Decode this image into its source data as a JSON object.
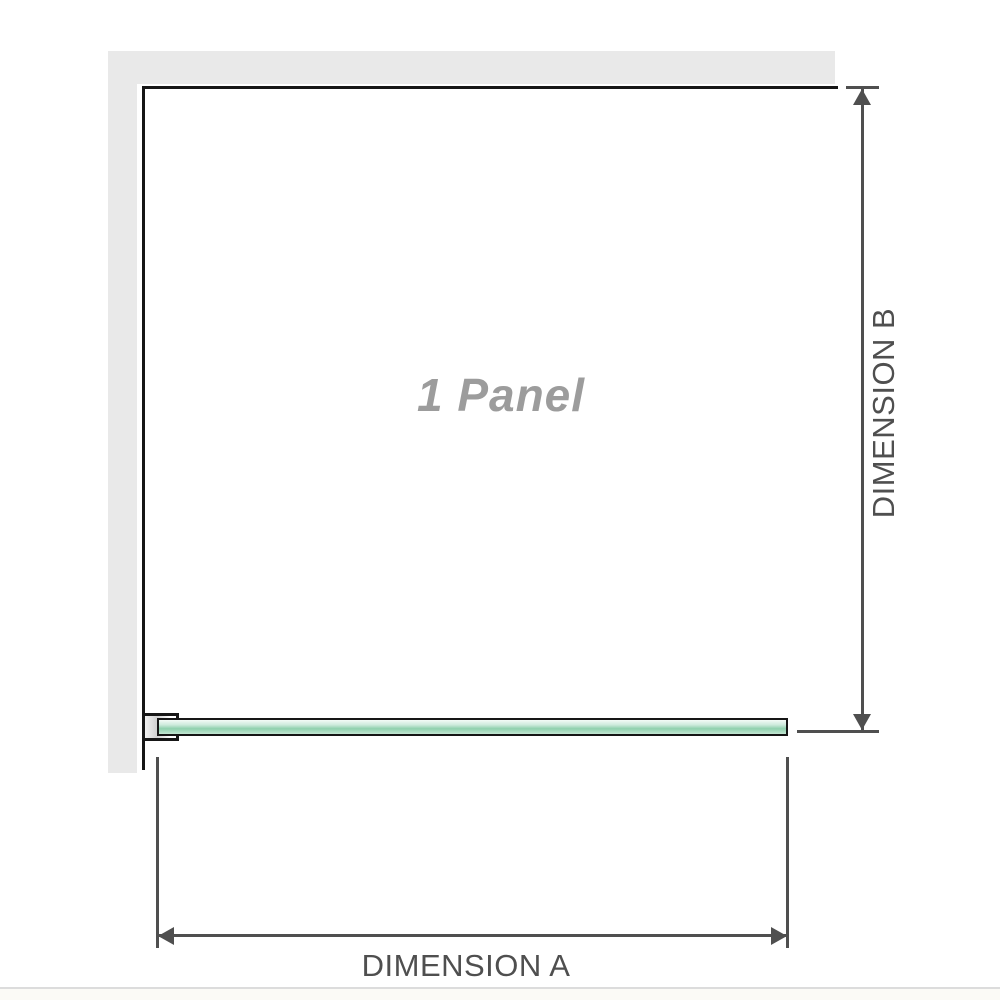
{
  "diagram": {
    "type": "product-dimension-diagram",
    "panel_label": "1 Panel",
    "panel_count": 1,
    "dimensions": {
      "width_label": "DIMENSION A",
      "height_label": "DIMENSION B"
    }
  },
  "colors": {
    "wall_gray": "#e9e9e9",
    "outline_black": "#161616",
    "dimension_gray": "#4f4f4f",
    "panel_label_gray": "#9c9c9c",
    "glass_green_mid": "#8fd0ad",
    "glass_green_light": "#cdeadc",
    "baseline_gray": "#dcdcdc"
  }
}
